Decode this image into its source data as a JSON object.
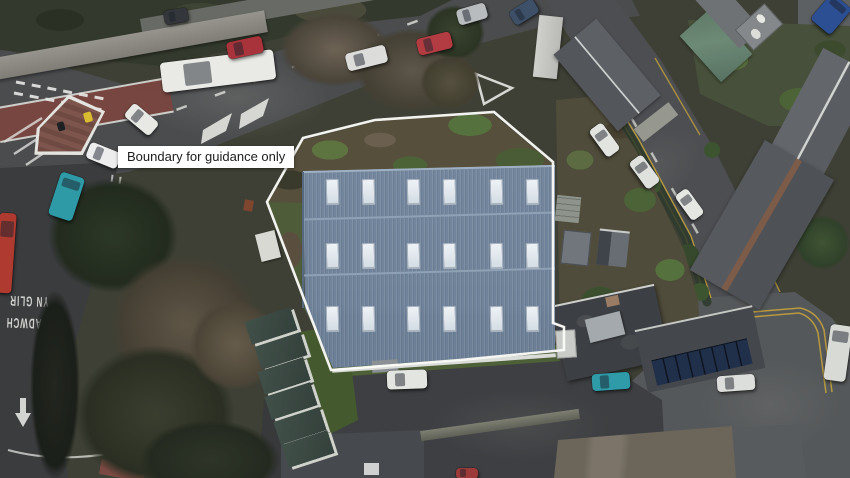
{
  "scene": {
    "description": "Aerial drone photograph of a large industrial building plot at a road junction, with a property boundary overlay",
    "boundary_label": "Boundary for guidance only"
  },
  "boundary": {
    "points": "303,138 375,120 494,112 553,162 553,323 564,327 564,350 460,360 331,370 267,202",
    "color": "#fafaf7"
  },
  "building": {
    "roof_color": "#74879e",
    "skylights": {
      "rows_y": [
        179,
        243,
        306
      ],
      "cols_x": [
        326,
        362,
        407,
        443,
        490,
        526
      ],
      "w": 11,
      "h": 24
    }
  },
  "road_texts": [
    {
      "name": "road-text-clear",
      "text": "CLEAR",
      "x": 86,
      "y": 229,
      "size": 10.5,
      "rot": 184
    },
    {
      "name": "road-text-keep",
      "text": "KEEP",
      "x": 96,
      "y": 258,
      "size": 10.5,
      "rot": 184
    },
    {
      "name": "road-text-yn-glir",
      "text": "YN GLIR",
      "x": 29,
      "y": 301,
      "size": 8,
      "rot": 182
    },
    {
      "name": "road-text-cadwch",
      "text": "CADWCH",
      "x": 27,
      "y": 323,
      "size": 8,
      "rot": 182
    }
  ],
  "vehicles": [
    {
      "name": "box-truck",
      "color": "#e9eae6",
      "cx": 218,
      "cy": 71,
      "w": 114,
      "h": 30,
      "rot": -7
    },
    {
      "name": "red-car-1",
      "color": "#a8333a",
      "cx": 245,
      "cy": 47,
      "w": 36,
      "h": 17,
      "rot": -12
    },
    {
      "name": "white-car-1",
      "color": "#e8e9e5",
      "cx": 141,
      "cy": 119,
      "w": 33,
      "h": 17,
      "rot": 40
    },
    {
      "name": "white-car-2",
      "color": "#ededee",
      "cx": 103,
      "cy": 155,
      "w": 33,
      "h": 17,
      "rot": 22
    },
    {
      "name": "teal-van",
      "color": "#2e9aa6",
      "cx": 66,
      "cy": 196,
      "w": 25,
      "h": 45,
      "rot": 18
    },
    {
      "name": "red-truck",
      "color": "#ae3a30",
      "cx": 5,
      "cy": 253,
      "w": 17,
      "h": 80,
      "rot": 4
    },
    {
      "name": "dark-car",
      "color": "#33363a",
      "cx": 176,
      "cy": 16,
      "w": 24,
      "h": 14,
      "rot": -10
    },
    {
      "name": "white-car-3",
      "color": "#dcdddb",
      "cx": 366,
      "cy": 58,
      "w": 41,
      "h": 18,
      "rot": -14
    },
    {
      "name": "red-car-2",
      "color": "#b23c42",
      "cx": 434,
      "cy": 43,
      "w": 35,
      "h": 17,
      "rot": -14
    },
    {
      "name": "silver-car",
      "color": "#b9bcbe",
      "cx": 472,
      "cy": 14,
      "w": 30,
      "h": 16,
      "rot": -16
    },
    {
      "name": "blue-car",
      "color": "#3d5068",
      "cx": 524,
      "cy": 12,
      "w": 28,
      "h": 16,
      "rot": -32
    },
    {
      "name": "white-car-4",
      "color": "#e2e4e0",
      "cx": 604,
      "cy": 140,
      "w": 33,
      "h": 16,
      "rot": 54
    },
    {
      "name": "white-car-5",
      "color": "#dfe1dd",
      "cx": 644,
      "cy": 172,
      "w": 33,
      "h": 16,
      "rot": 54
    },
    {
      "name": "white-car-6",
      "color": "#e5e7e3",
      "cx": 689,
      "cy": 204,
      "w": 31,
      "h": 15,
      "rot": 54
    },
    {
      "name": "blue-van",
      "color": "#2c4f93",
      "cx": 831,
      "cy": 14,
      "w": 26,
      "h": 34,
      "rot": 40
    },
    {
      "name": "teal-car",
      "color": "#2f9aa8",
      "cx": 611,
      "cy": 381,
      "w": 38,
      "h": 17,
      "rot": -4
    },
    {
      "name": "white-car-7",
      "color": "#dcdedb",
      "cx": 736,
      "cy": 383,
      "w": 38,
      "h": 16,
      "rot": -4
    },
    {
      "name": "white-van",
      "color": "#d8dad6",
      "cx": 838,
      "cy": 353,
      "w": 22,
      "h": 56,
      "rot": 8
    },
    {
      "name": "white-car-8",
      "color": "#e3e5e1",
      "cx": 407,
      "cy": 379,
      "w": 40,
      "h": 19,
      "rot": -2
    },
    {
      "name": "red-car-3",
      "color": "#9c3a3a",
      "cx": 467,
      "cy": 473,
      "w": 22,
      "h": 11,
      "rot": 0
    }
  ],
  "stepped_roofs": [
    {
      "cx": 271,
      "cy": 326
    },
    {
      "cx": 281,
      "cy": 351
    },
    {
      "cx": 284,
      "cy": 376
    },
    {
      "cx": 291,
      "cy": 401
    },
    {
      "cx": 300,
      "cy": 426
    },
    {
      "cx": 308,
      "cy": 449
    }
  ],
  "colors": {
    "asphalt": "#4a4c4e",
    "roof_blue_grey": "#74879e",
    "boundary_white": "#fafaf7",
    "label_bg": "#ffffff",
    "label_text": "#1c1c1c",
    "double_yellow": "#c2a13c",
    "grass": "#4d6038",
    "slate_roof": "#56585c",
    "tarp_green": "#5f7a68"
  }
}
